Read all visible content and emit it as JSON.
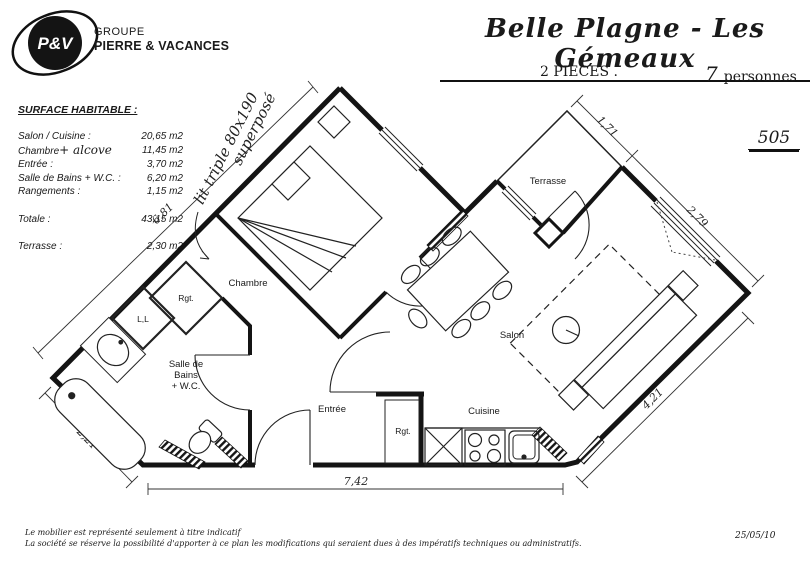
{
  "logo": {
    "monogram": "P&V",
    "group": "GROUPE",
    "brand": "PIERRE & VACANCES"
  },
  "header": {
    "title": "Belle Plagne - Les Gémeaux",
    "rooms_count": "2 PIECES .",
    "persons_value": "7",
    "persons_label": "personnes",
    "apartment_number": "505"
  },
  "surface_table": {
    "title": "SURFACE HABITABLE :",
    "rows": [
      {
        "label": "Salon / Cuisine :",
        "value": "20,65 m2"
      },
      {
        "label": "Chambre",
        "handwritten": "+ alcove",
        "value": "11,45 m2"
      },
      {
        "label": "Entrée :",
        "value": "3,70 m2"
      },
      {
        "label": "Salle de Bains + W.C. :",
        "value": "6,20 m2"
      },
      {
        "label": "Rangements :",
        "value": "1,15 m2"
      },
      {
        "label": "Totale :",
        "value": "43,15 m2"
      },
      {
        "label": "Terrasse :",
        "value": "2,30 m2"
      }
    ]
  },
  "annotations": {
    "bed_note_line1": "lit triple 80x190",
    "bed_note_line2": "superposé"
  },
  "dimensions": {
    "nw": "6,81",
    "sw": "2,21",
    "south": "7,42",
    "ne_terrace": "1,71",
    "ne_salon": "2,79",
    "se": "4,21"
  },
  "rooms": {
    "chambre": "Chambre",
    "salle_de_bains_line1": "Salle de",
    "salle_de_bains_line2": "Bains",
    "salle_de_bains_line3": "+ W.C.",
    "entree": "Entrée",
    "cuisine": "Cuisine",
    "salon": "Salon",
    "terrasse": "Terrasse",
    "rangement_bath": "Rgt.",
    "rangement_entree": "Rgt.",
    "lave_linge": "L,L"
  },
  "footer": {
    "line1": "Le mobilier est représenté seulement à titre indicatif",
    "line2": "La société se réserve la possibilité d'apporter à ce plan les modifications qui seraient dues à des impératifs techniques ou administratifs.",
    "date": "25/05/10"
  }
}
